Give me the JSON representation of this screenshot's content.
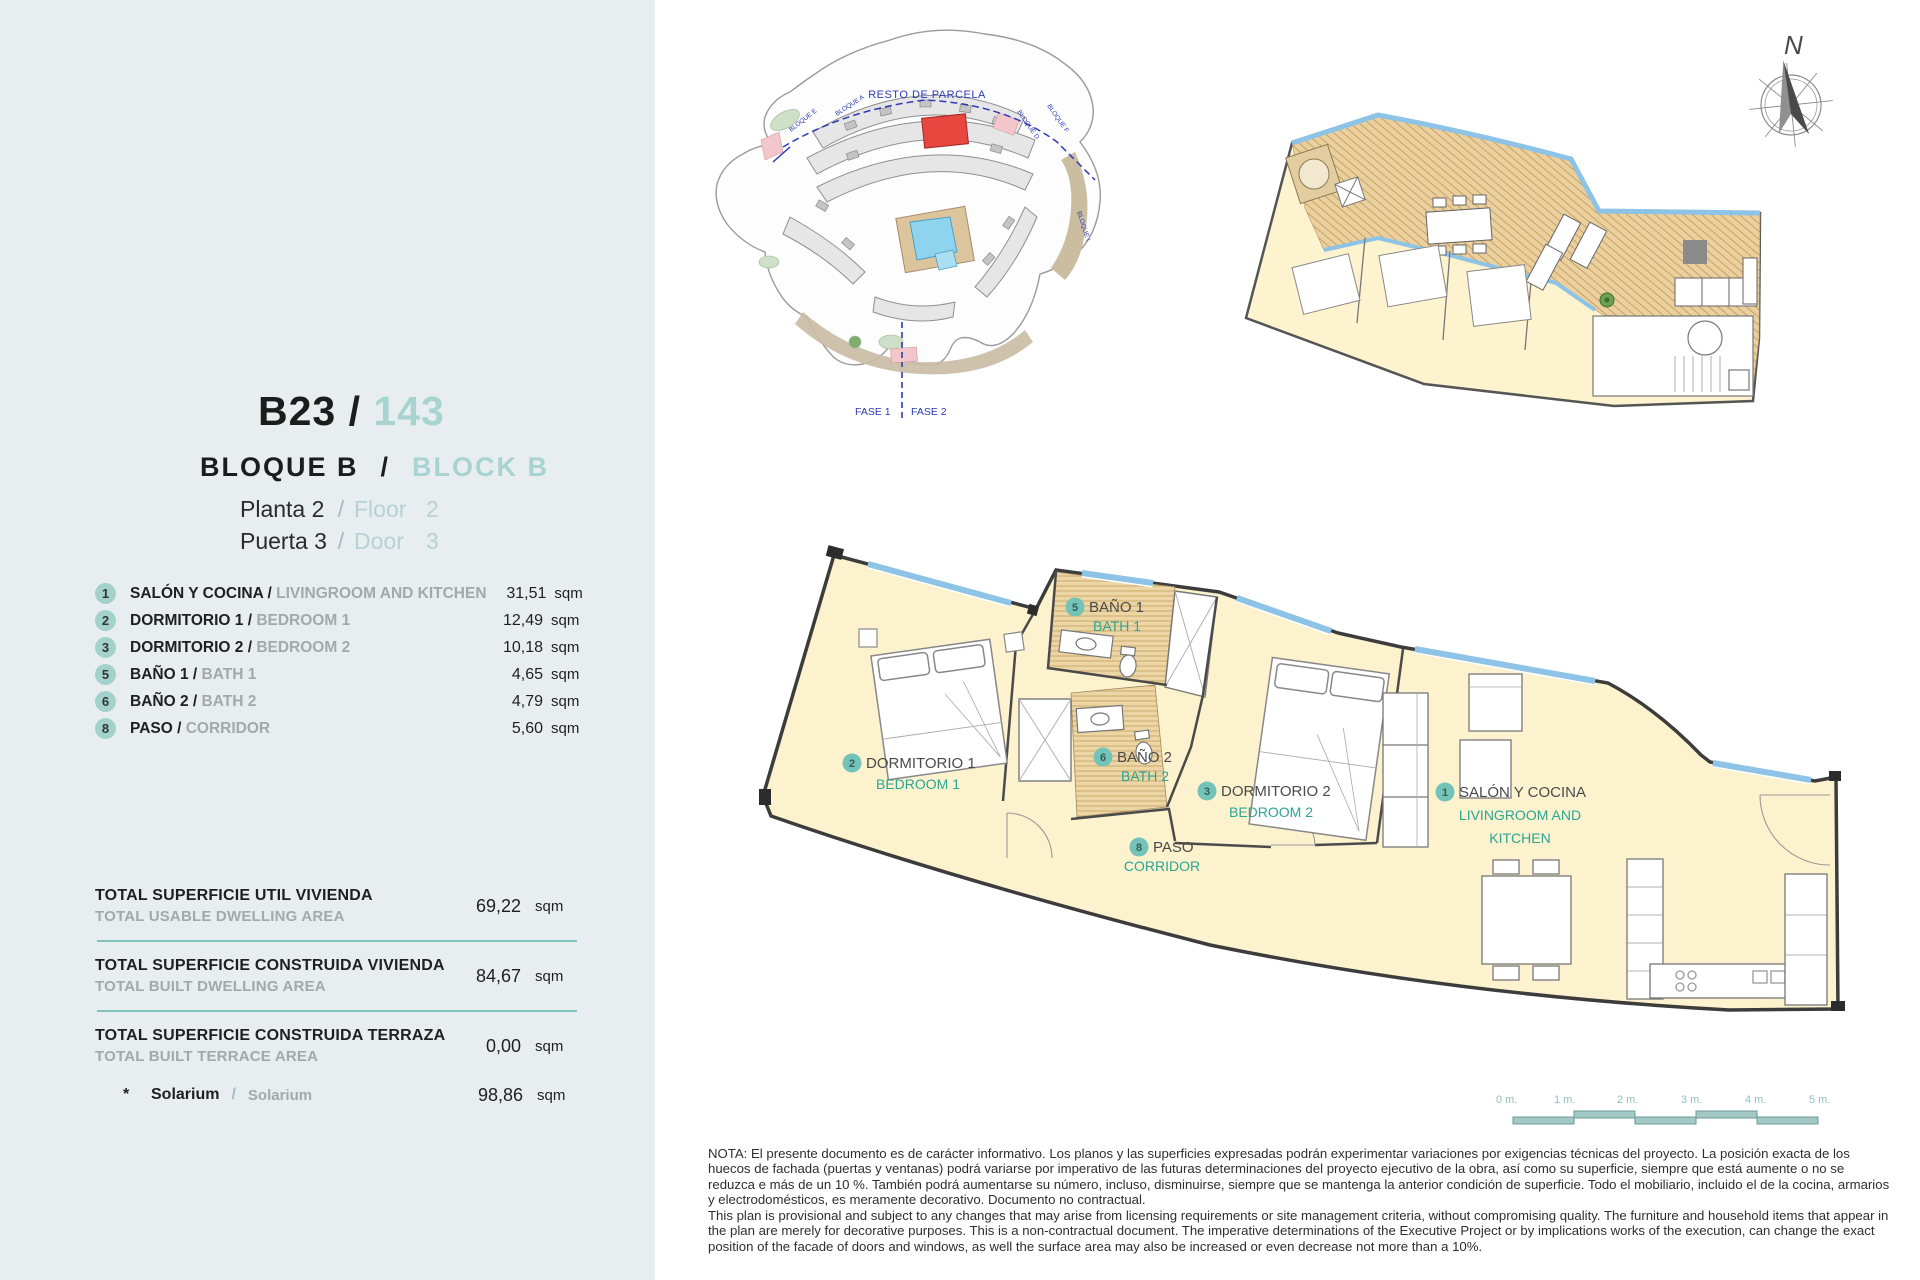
{
  "colors": {
    "panel_bg": "#e8eef0",
    "accent_teal": "#a7d4d0",
    "divider_teal": "#7ec5bf",
    "plan_label_teal": "#2aa596",
    "floor_fill": "#fcf2cd",
    "terrace_fill": "#ead09f",
    "window_blue": "#8cc3e6",
    "highlight_red": "#e8473f",
    "siteplan_blue": "#2b3bb5"
  },
  "panel": {
    "title": {
      "code": "B23",
      "sep": " / ",
      "number": "143"
    },
    "block": {
      "es": "BLOQUE B",
      "sep": "/",
      "en": "BLOCK B"
    },
    "location": {
      "floor_es": "Planta 2",
      "floor_sep": "/",
      "floor_en": "Floor",
      "floor_num": "2",
      "door_es": "Puerta 3",
      "door_sep": "/",
      "door_en": "Door",
      "door_num": "3"
    },
    "rooms": [
      {
        "num": "1",
        "es": "SALÓN Y COCINA /",
        "en": "LIVINGROOM AND KITCHEN",
        "value": "31,51",
        "unit": "sqm"
      },
      {
        "num": "2",
        "es": "DORMITORIO 1 /",
        "en": "BEDROOM 1",
        "value": "12,49",
        "unit": "sqm"
      },
      {
        "num": "3",
        "es": "DORMITORIO 2 /",
        "en": "BEDROOM 2",
        "value": "10,18",
        "unit": "sqm"
      },
      {
        "num": "5",
        "es": "BAÑO 1 /",
        "en": "BATH 1",
        "value": "4,65",
        "unit": "sqm"
      },
      {
        "num": "6",
        "es": "BAÑO 2 /",
        "en": "BATH 2",
        "value": "4,79",
        "unit": "sqm"
      },
      {
        "num": "8",
        "es": "PASO /",
        "en": "CORRIDOR",
        "value": "5,60",
        "unit": "sqm"
      }
    ],
    "totals": [
      {
        "es": "TOTAL SUPERFICIE UTIL VIVIENDA",
        "en": "TOTAL USABLE DWELLING AREA",
        "value": "69,22",
        "unit": "sqm"
      },
      {
        "es": "TOTAL SUPERFICIE CONSTRUIDA VIVIENDA",
        "en": "TOTAL BUILT DWELLING AREA",
        "value": "84,67",
        "unit": "sqm"
      },
      {
        "es": "TOTAL SUPERFICIE CONSTRUIDA TERRAZA",
        "en": "TOTAL BUILT TERRACE AREA",
        "value": "0,00",
        "unit": "sqm"
      }
    ],
    "solarium": {
      "star": "*",
      "es": "Solarium",
      "sep": "/",
      "en": "Solarium",
      "value": "98,86",
      "unit": "sqm"
    }
  },
  "site_plan": {
    "resto_label": "RESTO DE PARCELA",
    "fase1": "FASE 1",
    "fase2": "FASE 2",
    "blocks": [
      "BLOQUE E",
      "BLOQUE A",
      "BLOQUE D",
      "BLOQUE F",
      "BLOQUE I"
    ]
  },
  "compass": {
    "north_label": "N"
  },
  "floor_plan": {
    "labels": [
      {
        "num": "5",
        "es": "BAÑO 1",
        "en": "BATH 1"
      },
      {
        "num": "2",
        "es": "DORMITORIO 1",
        "en": "BEDROOM 1"
      },
      {
        "num": "6",
        "es": "BAÑO 2",
        "en": "BATH 2"
      },
      {
        "num": "3",
        "es": "DORMITORIO 2",
        "en": "BEDROOM 2"
      },
      {
        "num": "1",
        "es": "SALÓN Y COCINA",
        "en_line1": "LIVINGROOM AND",
        "en_line2": "KITCHEN"
      },
      {
        "num": "8",
        "es": "PASO",
        "en": "CORRIDOR"
      }
    ]
  },
  "scale_bar": {
    "ticks": [
      "0 m.",
      "1 m.",
      "2 m.",
      "3 m.",
      "4 m.",
      "5 m."
    ]
  },
  "note": {
    "es": "NOTA: El presente documento es de carácter informativo. Los planos y las superficies expresadas podrán experimentar variaciones por exigencias técnicas del proyecto. La posición exacta de los huecos de fachada (puertas y ventanas) podrá variarse por imperativo de las futuras determinaciones del proyecto ejecutivo de la obra, así como su superficie, siempre que está aumente o no se reduzca e más de un 10 %. También podrá aumentarse su número, incluso, disminuirse, siempre que se mantenga la anterior condición de superficie. Todo el mobiliario, incluido el de la cocina, armarios y electrodomésticos, es meramente decorativo. Documento no contractual.",
    "en": "This plan is provisional and subject to any changes that may arise from licensing requirements or site management criteria, without compromising quality. The furniture and household items that appear in the plan are merely for decorative purposes. This is a non-contractual document. The imperative determinations of the Executive Project or by implications works of the execution, can change the exact position of the facade of doors and windows, as well the surface area may also be increased or even decrease not more than a 10%."
  }
}
